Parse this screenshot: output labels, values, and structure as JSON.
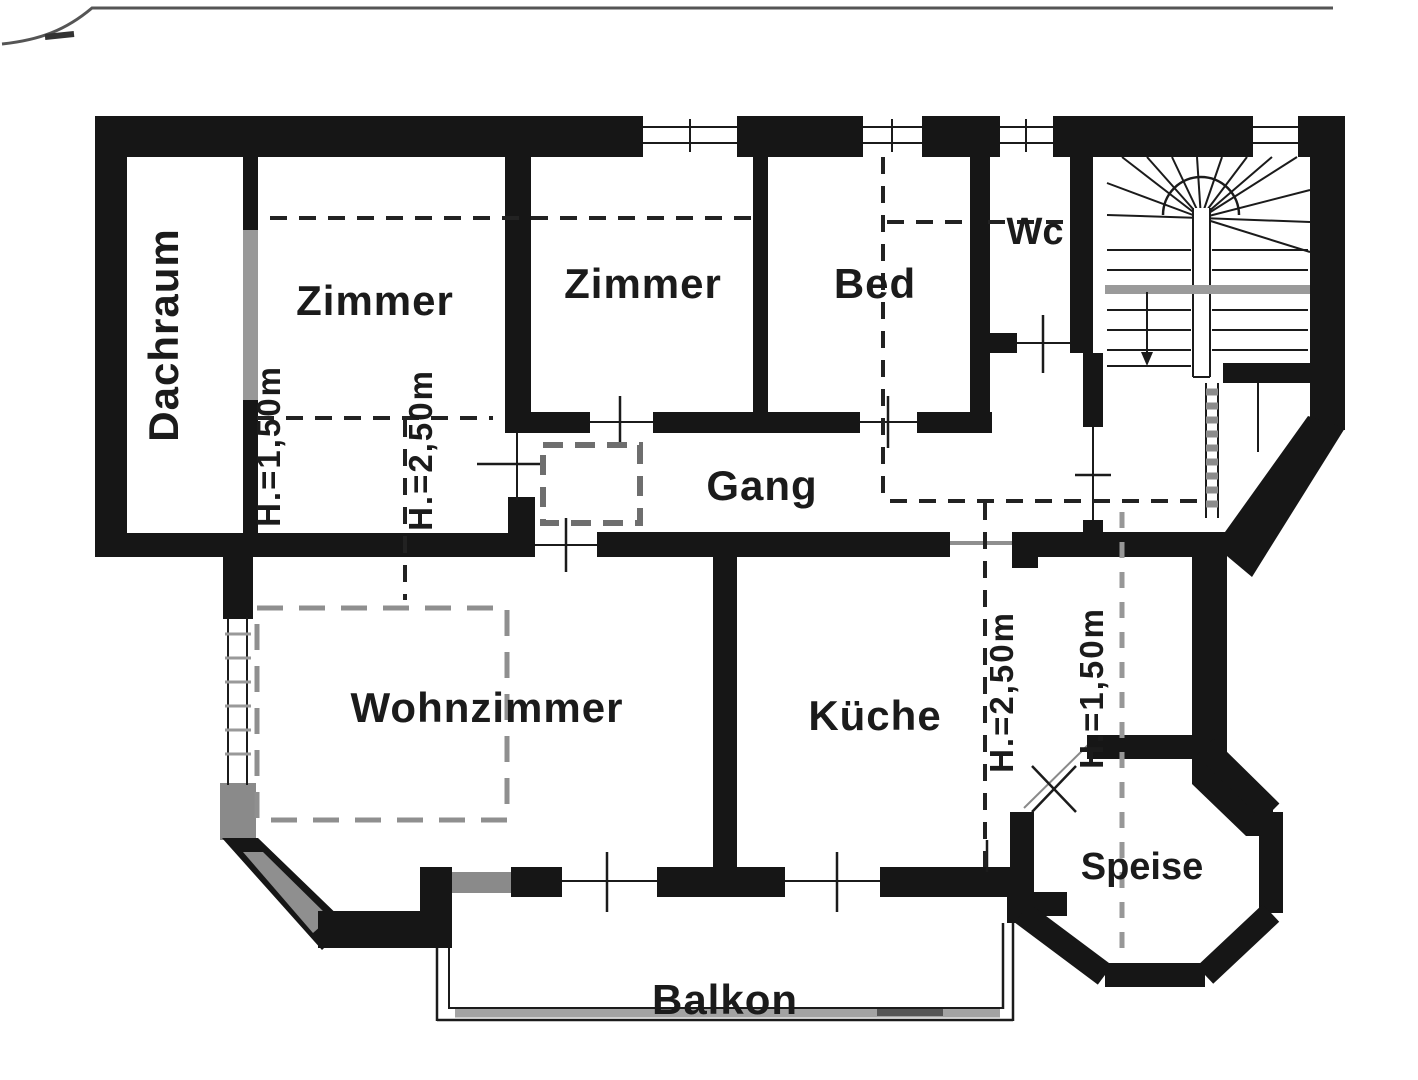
{
  "document": {
    "kind_label": "floor-plan-scan"
  },
  "colors": {
    "paper": "#ffffff",
    "ink": "#161616",
    "gray_wall": "#8a8a8a",
    "gray_dash": "#979797",
    "text": "#1b1b1b"
  },
  "rooms": [
    {
      "id": "dachraum",
      "label": "Dachraum"
    },
    {
      "id": "zimmer-1",
      "label": "Zimmer"
    },
    {
      "id": "zimmer-2",
      "label": "Zimmer"
    },
    {
      "id": "bed",
      "label": "Bed"
    },
    {
      "id": "wc",
      "label": "Wc"
    },
    {
      "id": "gang",
      "label": "Gang"
    },
    {
      "id": "wohnzimmer",
      "label": "Wohnzimmer"
    },
    {
      "id": "kueche",
      "label": "Küche"
    },
    {
      "id": "speise",
      "label": "Speise"
    },
    {
      "id": "balkon",
      "label": "Balkon"
    }
  ],
  "height_annotations": [
    {
      "id": "left-eave",
      "label": "H.=1,50m"
    },
    {
      "id": "left-mid",
      "label": "H.=2,50m"
    },
    {
      "id": "right-mid",
      "label": "H.=2,50m"
    },
    {
      "id": "right-eave",
      "label": "H.=1,50m"
    }
  ]
}
